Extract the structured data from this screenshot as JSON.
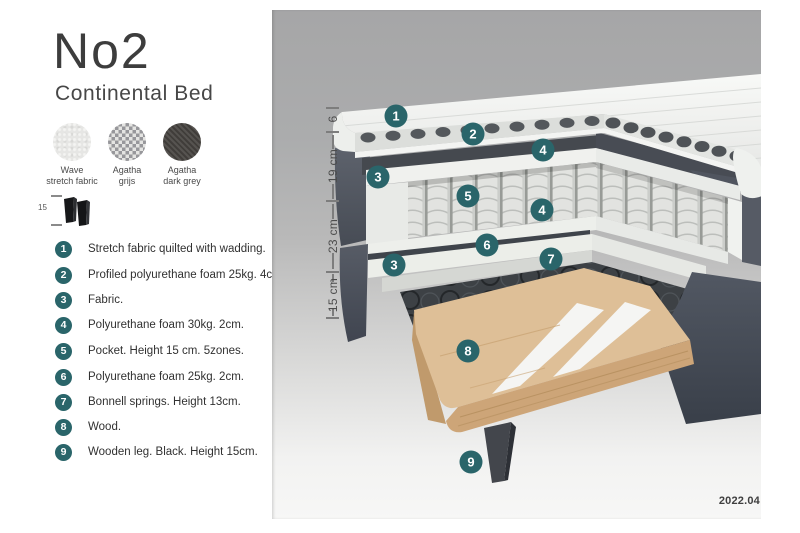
{
  "page": {
    "version_label": "2022.04"
  },
  "product": {
    "title": "No2",
    "subtitle": "Continental Bed"
  },
  "swatches": [
    {
      "name": "wave-stretch-fabric",
      "label_line1": "Wave",
      "label_line2": "stretch fabric"
    },
    {
      "name": "agatha-grijs",
      "label_line1": "Agatha",
      "label_line2": "grijs"
    },
    {
      "name": "agatha-dark-grey",
      "label_line1": "Agatha",
      "label_line2": "dark grey"
    }
  ],
  "leg_detail": {
    "height_label": "15"
  },
  "legend": {
    "items": [
      {
        "num": "1",
        "text": "Stretch fabric quilted with wadding."
      },
      {
        "num": "2",
        "text": "Profiled polyurethane foam 25kg. 4cm."
      },
      {
        "num": "3",
        "text": "Fabric."
      },
      {
        "num": "4",
        "text": "Polyurethane foam 30kg. 2cm."
      },
      {
        "num": "5",
        "text": "Pocket. Height 15 cm. 5zones."
      },
      {
        "num": "6",
        "text": "Polyurethane foam 25kg. 2cm."
      },
      {
        "num": "7",
        "text": "Bonnell springs. Height 13cm."
      },
      {
        "num": "8",
        "text": "Wood."
      },
      {
        "num": "9",
        "text": "Wooden leg. Black. Height 15cm."
      }
    ]
  },
  "measurements": {
    "labels": [
      {
        "text": "6"
      },
      {
        "text": "19 cm"
      },
      {
        "text": "23 cm"
      },
      {
        "text": "15 cm"
      }
    ]
  },
  "diagram_badges": [
    {
      "num": "1"
    },
    {
      "num": "2"
    },
    {
      "num": "4"
    },
    {
      "num": "3"
    },
    {
      "num": "5"
    },
    {
      "num": "4"
    },
    {
      "num": "6"
    },
    {
      "num": "7"
    },
    {
      "num": "3"
    },
    {
      "num": "8"
    },
    {
      "num": "9"
    }
  ],
  "colors": {
    "badge_teal": "#2a656a",
    "fabric_gray": "#575c66",
    "topper_white": "#f3f4f2",
    "wood": "#debf97",
    "leg_black": "#3a3d43",
    "diagram_bg_top": "#a6a6a7",
    "diagram_bg_bottom": "#f7f7f6"
  }
}
